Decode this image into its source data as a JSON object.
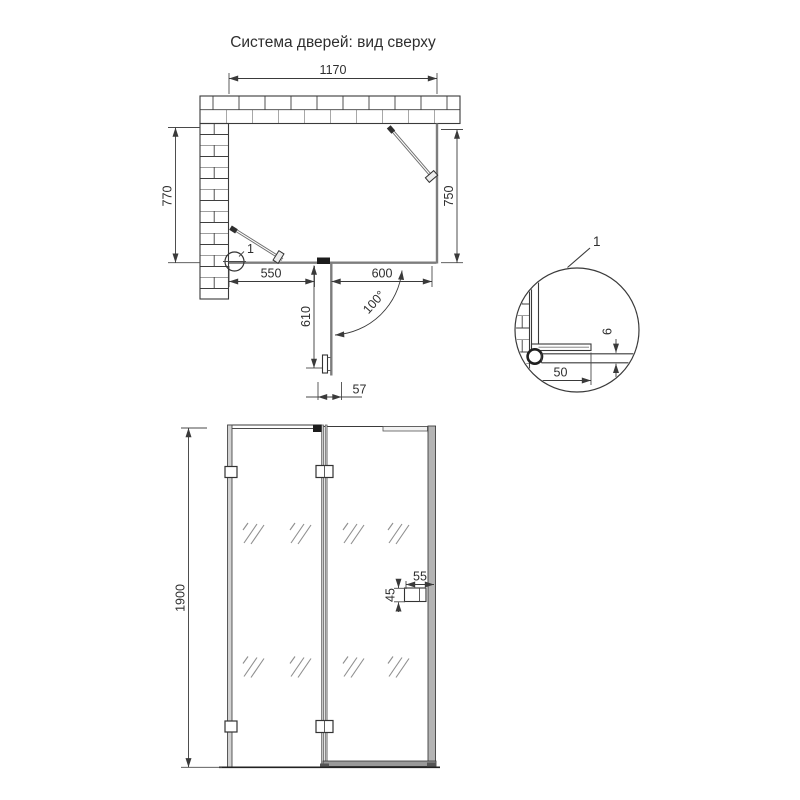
{
  "title": "Система дверей: вид сверху",
  "top_view": {
    "dim_total_width": "1170",
    "dim_left_depth": "770",
    "dim_right_depth": "750",
    "dim_fixed_section": "550",
    "dim_door_section": "600",
    "dim_door_open": "610",
    "dim_threshold": "57",
    "dim_open_angle": "100°",
    "detail_marker": "1"
  },
  "detail_view": {
    "label": "1",
    "dim_wall_profile": "50",
    "dim_glass_thickness": "6"
  },
  "front_view": {
    "dim_height": "1900",
    "dim_handle_width": "55",
    "dim_handle_height": "45"
  },
  "colors": {
    "line": "#3a3a3a",
    "glass_gray": "#7d7d7d",
    "profile_fill": "#c9c9c9"
  }
}
